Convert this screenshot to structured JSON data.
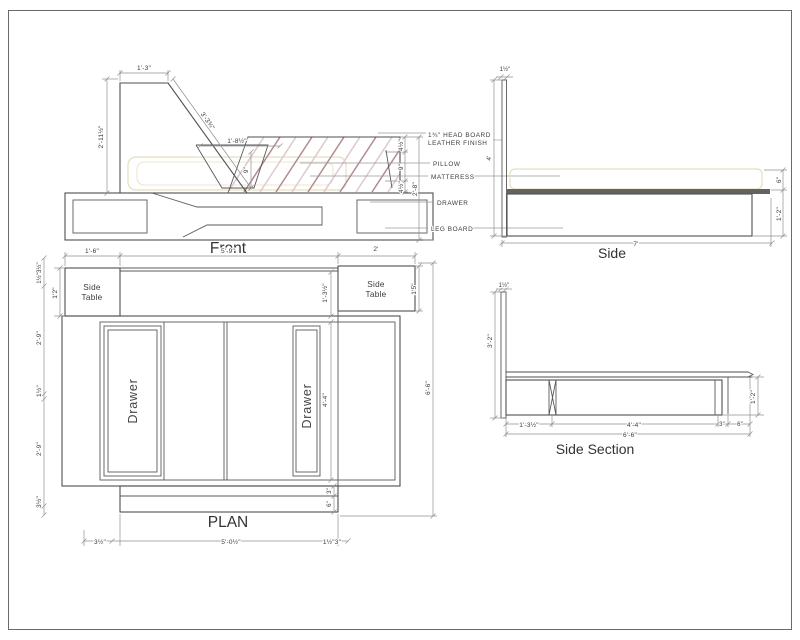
{
  "colors": {
    "line": "#4f4f4f",
    "dimension": "#8f8f8f",
    "hatch_dark": "#b18b90",
    "hatch_light": "#dec9cc",
    "soft_outline": "#e6dfbc"
  },
  "drawing": {
    "front": {
      "title": "Front",
      "dims": {
        "top_width": "1'-3\"",
        "height": "2'-11½\"",
        "slant": "3'-3¾\"",
        "pillow_width": "1'-8½\"",
        "pillow_height": "9\"",
        "gap_top": "4½\"",
        "mattress_thickness": "9\"",
        "gap_bottom": "4½\"",
        "overall_height": "2'-8\""
      },
      "callouts": {
        "headboard_line1": "1¾\" HEAD BOARD",
        "headboard_line2": "LEATHER FINISH",
        "pillow": "PILLOW",
        "mattress": "MATTERESS",
        "drawer": "DRAWER",
        "leg_board": "LEG BOARD"
      }
    },
    "side": {
      "title": "Side",
      "dims": {
        "board_thickness": "1½\"",
        "board_height": "4'",
        "mattress_height": "6\"",
        "base_height": "1'-2\"",
        "length": "7'"
      }
    },
    "plan": {
      "title": "PLAN",
      "side_table_line1": "Side",
      "side_table_line2": "Table",
      "drawer_label": "Drawer",
      "dims": {
        "top_left": "1'-6\"",
        "top_middle": "5'-9\"",
        "top_right": "2'",
        "left_top": "1½\"3½\"",
        "table_depth": "1'2\"",
        "left_upper": "2'-9\"",
        "left_middle": "1½\"",
        "left_lower": "2'-9\"",
        "left_bottom": "3½\"",
        "gap_depth": "1'-3½\"",
        "drawer_length": "4'-4\"",
        "footer_top": "3\"",
        "footer_bottom": "6\"",
        "right_table_depth": "1'5\"",
        "overall_width": "6'-6\"",
        "bottom_left": "3½\"",
        "bottom_middle": "5'-0½\"",
        "bottom_right": "1½\"3\""
      }
    },
    "side_section": {
      "title": "Side Section",
      "dims": {
        "board_thickness": "1½\"",
        "board_height": "3'-2\"",
        "seg_head": "1'-3½\"",
        "seg_drawer": "4'-4\"",
        "seg_leg": "3\"",
        "seg_overhang": "6\"",
        "overall": "6'-6\"",
        "base_height": "1'-2\""
      }
    }
  }
}
